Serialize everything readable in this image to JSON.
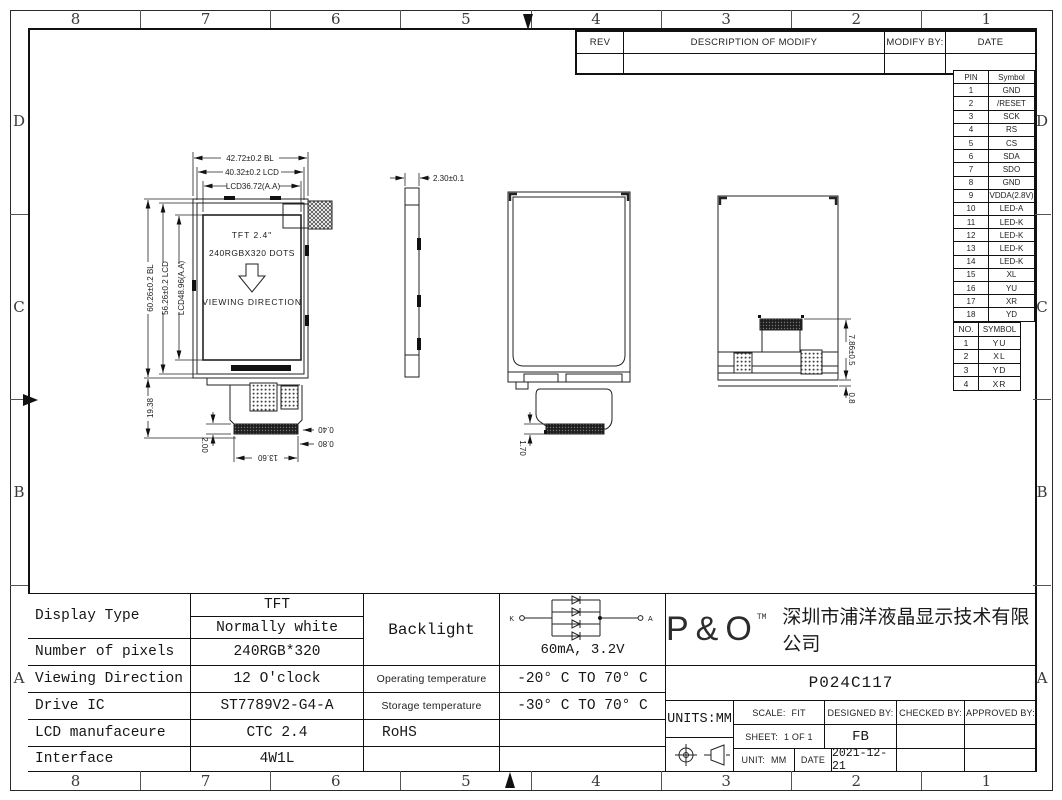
{
  "sheet": {
    "border_cols": [
      "8",
      "7",
      "6",
      "5",
      "4",
      "3",
      "2",
      "1"
    ],
    "border_rows": [
      "D",
      "C",
      "B",
      "A"
    ]
  },
  "rev_table": {
    "headers": [
      "REV",
      "DESCRIPTION OF MODIFY",
      "MODIFY BY:",
      "DATE"
    ]
  },
  "pin_table": {
    "headers": [
      "PIN",
      "Symbol"
    ],
    "rows": [
      [
        "1",
        "GND"
      ],
      [
        "2",
        "/RESET"
      ],
      [
        "3",
        "SCK"
      ],
      [
        "4",
        "RS"
      ],
      [
        "5",
        "CS"
      ],
      [
        "6",
        "SDA"
      ],
      [
        "7",
        "SDO"
      ],
      [
        "8",
        "GND"
      ],
      [
        "9",
        "VDDA(2.8V)"
      ],
      [
        "10",
        "LED-A"
      ],
      [
        "11",
        "LED-K"
      ],
      [
        "12",
        "LED-K"
      ],
      [
        "13",
        "LED-K"
      ],
      [
        "14",
        "LED-K"
      ],
      [
        "15",
        "XL"
      ],
      [
        "16",
        "YU"
      ],
      [
        "17",
        "XR"
      ],
      [
        "18",
        "YD"
      ]
    ]
  },
  "touch_pin_table": {
    "headers": [
      "NO.",
      "SYMBOL"
    ],
    "rows": [
      [
        "1",
        "YU"
      ],
      [
        "2",
        "XL"
      ],
      [
        "3",
        "YD"
      ],
      [
        "4",
        "XR"
      ]
    ]
  },
  "front_view": {
    "title": "TFT 2.4\"",
    "subtitle": "240RGBX320 DOTS",
    "direction_label": "VIEWING DIRECTION",
    "dim_width_bl": "42.72±0.2 BL",
    "dim_width_lcd": "40.32±0.2 LCD",
    "dim_width_aa": "LCD36.72(A.A)",
    "dim_height_bl": "60.26±0.2 BL",
    "dim_height_lcd": "56.26±0.2 LCD",
    "dim_height_aa": "LCD48.96(A.A)",
    "dim_tail": "19.38",
    "dim_tail_h": "2.00",
    "dim_off1": "0.40",
    "dim_off2": "0.80",
    "dim_conn": "13.60"
  },
  "side_view": {
    "dim_thickness": "2.30±0.1"
  },
  "rear_view": {
    "dim_conn": "1.70"
  },
  "rear_folded_view": {
    "dim_fpc": "7.86±0.5",
    "dim_gap": "0.8"
  },
  "spec_table": {
    "display_type_label": "Display Type",
    "display_type_1": "TFT",
    "display_type_2": "Normally white",
    "pixels_label": "Number of pixels",
    "pixels": "240RGB*320",
    "viewing_label": "Viewing Direction",
    "viewing": "12 O'clock",
    "drive_label": "Drive IC",
    "drive": "ST7789V2-G4-A",
    "manu_label": "LCD manufaceure",
    "manu": "CTC 2.4",
    "interface_label": "Interface",
    "interface": "4W1L"
  },
  "env_table": {
    "backlight_label": "Backlight",
    "backlight_value": "60mA, 3.2V",
    "led_k": "K",
    "led_a": "A",
    "op_label": "Operating temperature",
    "op_value": "-20° C TO 70° C",
    "st_label": "Storage temperature",
    "st_value": "-30° C TO 70° C",
    "rohs_label": "RoHS"
  },
  "title_block": {
    "logo": "P&O",
    "logo_tm": "TM",
    "company": "深圳市浦洋液晶显示技术有限公司",
    "part_number": "P024C117",
    "units": "UNITS:MM",
    "scale_label": "SCALE:",
    "scale_value": "FIT",
    "designed_label": "DESIGNED BY:",
    "designed_value": "FB",
    "checked_label": "CHECKED BY:",
    "approved_label": "APPROVED BY:",
    "sheet_label": "SHEET:",
    "sheet_value": "1 OF 1",
    "unit_label": "UNIT:",
    "unit_value": "MM",
    "date_label": "DATE",
    "date_value": "2021-12-21"
  }
}
